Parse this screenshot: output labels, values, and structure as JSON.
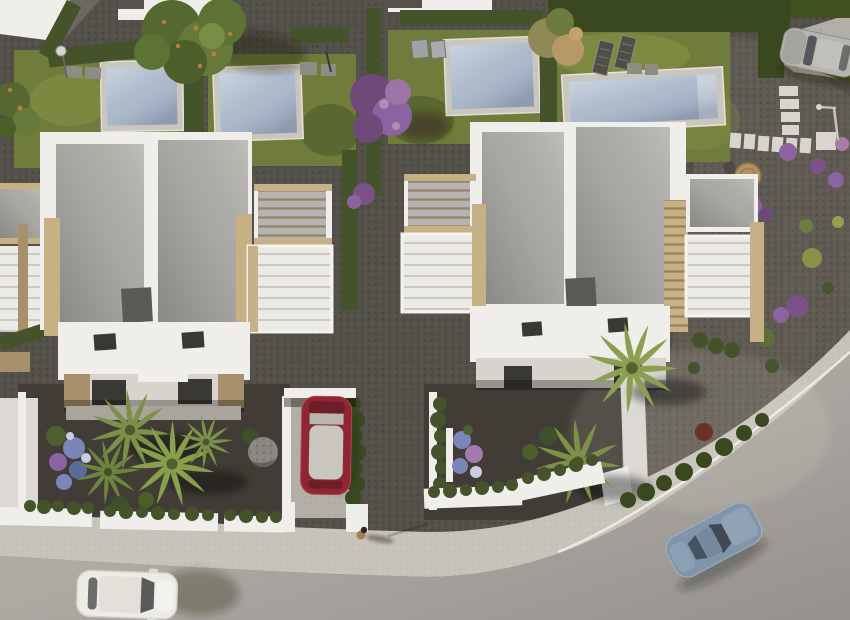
{
  "meta": {
    "type": "aerial-3d-render",
    "description": "Bird's-eye 3D render of a modern residential development: two white flat-roof villas with travertine accents, four swimming pools on lawns, gravel gardens with palms and purple blooms, a curving street with parked cars and a pedestrian"
  },
  "colors": {
    "gravel_base": "#54504a",
    "gravel_light": "#615c53",
    "yard_gravel": "#413d36",
    "grass": "#6f7c3c",
    "grass_light": "#84903f",
    "grass_dark": "#4f5c2c",
    "hedge": "#45532a",
    "cypress": "#39481f",
    "pool_border": "#c9c6be",
    "pool_water": "#a9b7ca",
    "pool_water_light": "#c6cedb",
    "roof": "#b5b3af",
    "white_wall": "#f0eeea",
    "white_shade": "#dcd9d4",
    "travertine": "#c6b085",
    "travertine_shade": "#a8906a",
    "road": "#aeaba5",
    "road_upper": "#b2afa9",
    "sidewalk": "#c6c3bb",
    "curb": "#eceae4",
    "window_dark": "#3a3833",
    "chimney": "#5b5954",
    "red_car": "#8e2733",
    "red_car_dark": "#6e1e29",
    "car_glass": "#c9c6bf",
    "white_car": "#ecebe5",
    "blue_car": "#8094aa",
    "blue_car_dark": "#46525f",
    "silver_car": "#b7b5b0",
    "palm": "#7c9148",
    "palm_dark": "#50652e",
    "purple_bloom": "#8a63a0",
    "purple_deep": "#6f4a78",
    "blue_flower": "#7a86b8",
    "red_bush": "#6b3028",
    "table_wood": "#b2925f",
    "furniture": "#4f4d48",
    "slab": "#8f8c84",
    "stone_path": "#d8d5ce",
    "tree_green": "#5d7334",
    "tree_tan": "#b59a66",
    "orange_fruit": "#c07a3a",
    "person_skin": "#a87c50",
    "person_hair": "#2f2620",
    "shadow": "rgba(25,22,18,0.35)"
  },
  "scene": {
    "objects": [
      "left-villa",
      "right-villa",
      "neighbor-terrace",
      "pool-1",
      "pool-2",
      "pool-3",
      "pool-4",
      "white-car",
      "red-car",
      "blue-car",
      "silver-car",
      "pedestrian",
      "street",
      "sidewalk",
      "sun-loungers",
      "garden-table",
      "stepping-stones",
      "palm-trees",
      "purple-tree",
      "large-tree",
      "flower-beds",
      "street-lamps"
    ],
    "counts": {
      "villas": 2,
      "pools": 4,
      "cars": 4,
      "pedestrians": 1,
      "palm_trees": 6,
      "sun_loungers": 2
    }
  }
}
